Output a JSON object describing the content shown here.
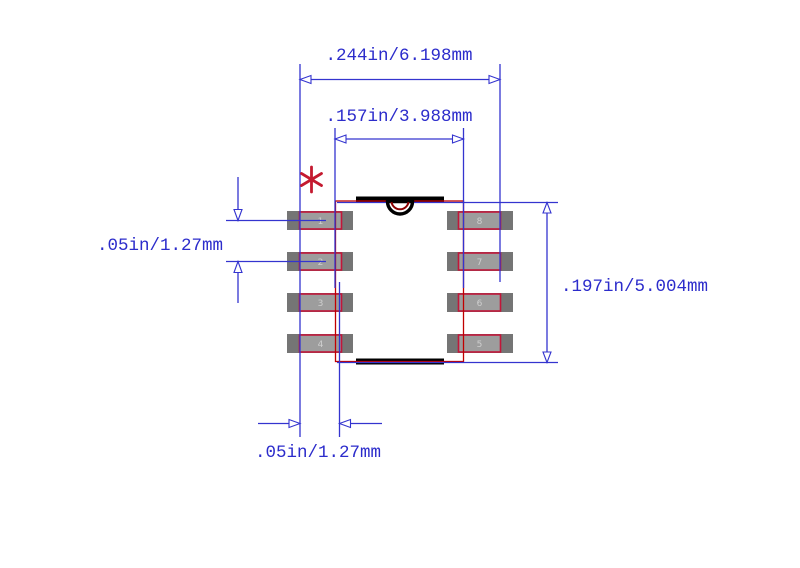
{
  "drawing": {
    "dim_top_outer": {
      "label": ".244in/6.198mm"
    },
    "dim_top_inner": {
      "label": ".157in/3.988mm"
    },
    "dim_pitch_left": {
      "label": ".05in/1.27mm"
    },
    "dim_height_right": {
      "label": ".197in/5.004mm"
    },
    "dim_pad_bottom": {
      "label": ".05in/1.27mm"
    },
    "pin1_marker": "*",
    "pins_left": [
      "1",
      "2",
      "3",
      "4"
    ],
    "pins_right": [
      "8",
      "7",
      "6",
      "5"
    ],
    "colors": {
      "dimension_blue": "#3434cf",
      "label_blue": "#2c2ccb",
      "body_outline_red": "#c00000",
      "pad_spec_red": "#c21639",
      "pad_copper_gray": "#757575",
      "pad_inner_gray": "#9d9d9d",
      "pin_number_gray": "#cfcfcf",
      "bar_black": "#000000",
      "notch_dark_red": "#8b0000",
      "marker_red": "#c41a30",
      "background": "#ffffff"
    }
  }
}
